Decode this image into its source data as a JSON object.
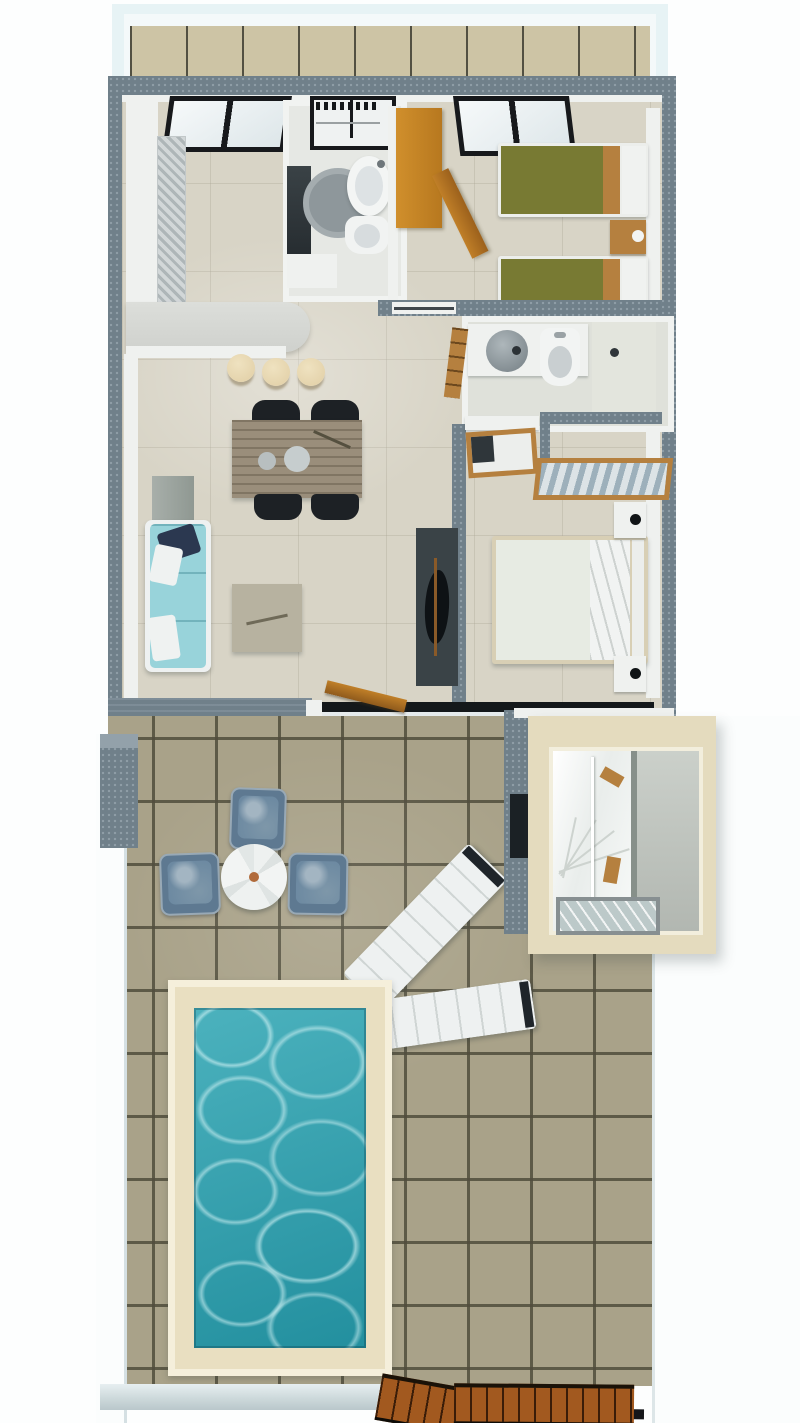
{
  "scene": {
    "type": "3d-floor-plan-render",
    "view": "top-down",
    "subject": "apartment with two bedrooms, two bathrooms, open kitchen-living room, terrace with stairwell cutaway and private pool",
    "visible_text": "none"
  },
  "palette": {
    "page_bg": "#fdfefe",
    "balcony_frame": "#e7f3f5",
    "balcony_tile": "#cdc4a5",
    "wall_slate": "#70808a",
    "wall_white": "#eff1ef",
    "floor_cream": "#d8d4c6",
    "terrace_tile": "#a9a289",
    "terrace_grout": "#50504c",
    "pool_deck": "#e9dfc1",
    "pool_water": "#29a3b1",
    "sofa_teal": "#98d3da",
    "pillow_navy": "#2b3850",
    "wood_tan": "#b5803f",
    "wardrobe_orange": "#d08f2c",
    "bed_olive": "#787a33",
    "duvet_base": "#e7ebe3",
    "duvet_leaf": "#8fa08e",
    "chair_black": "#1d2125",
    "rug_charcoal": "#3a4347",
    "armchair_blue": "#5e7991",
    "armchair_cushion": "#6c89a1",
    "stool_cream": "#e5d4ad",
    "white_furn": "#eef1f1",
    "stair_frame_cream": "#e4dbbe",
    "stair_wall": "#cbd0ca",
    "glass": "#bcc9c9",
    "gate_wood": "#a2591f",
    "table_wood": "#9a8e7b",
    "track_black": "#14181a",
    "band_blue": "#cdd9db"
  },
  "areas": {
    "balcony": {
      "label": "balcony"
    },
    "kitchen": {
      "label": "kitchen",
      "items": [
        "window",
        "wall-counter",
        "tall-cabinet",
        "curved-breakfast-bar",
        "bar-stool",
        "bar-stool",
        "bar-stool"
      ]
    },
    "main_bathroom": {
      "label": "main-bathroom",
      "items": [
        "washer-dryer",
        "dark-vanity",
        "base-cabinet",
        "round-rug",
        "oval-sink",
        "toilet"
      ]
    },
    "hallway": {
      "label": "hallway",
      "items": [
        "orange-wardrobe",
        "open-wardrobe-door"
      ]
    },
    "twin_bedroom": {
      "label": "twin-bedroom",
      "items": [
        "window",
        "single-bed",
        "single-bed",
        "shared-nightstand"
      ]
    },
    "ensuite_bathroom": {
      "label": "ensuite-bathroom",
      "items": [
        "vanity-counter",
        "vessel-sink",
        "toilet",
        "walk-in-shower",
        "towel-ladder"
      ]
    },
    "master_bedroom": {
      "label": "master-bedroom",
      "items": [
        "desk",
        "wooden-chair",
        "wardrobe-return",
        "luggage-bench",
        "double-bed-floral",
        "nightstand",
        "nightstand"
      ]
    },
    "living_dining": {
      "label": "living-dining-room",
      "items": [
        "teal-sofa",
        "side-table",
        "dining-table",
        "dining-chair",
        "dining-chair",
        "dining-chair",
        "dining-chair",
        "coffee-table",
        "tv-unit-on-rug",
        "entry-door"
      ]
    },
    "terrace": {
      "label": "terrace",
      "items": [
        "stone-planter",
        "outdoor-armchair",
        "outdoor-armchair",
        "outdoor-armchair",
        "round-side-table",
        "sun-lounger",
        "sun-lounger",
        "stairwell-cutaway",
        "swimming-pool",
        "wooden-gate",
        "wooden-gate"
      ]
    }
  },
  "counts": {
    "rooms": 6,
    "bar_stools": 3,
    "dining_chairs": 4,
    "outdoor_armchairs": 3,
    "sun_loungers": 2,
    "beds": 3
  }
}
